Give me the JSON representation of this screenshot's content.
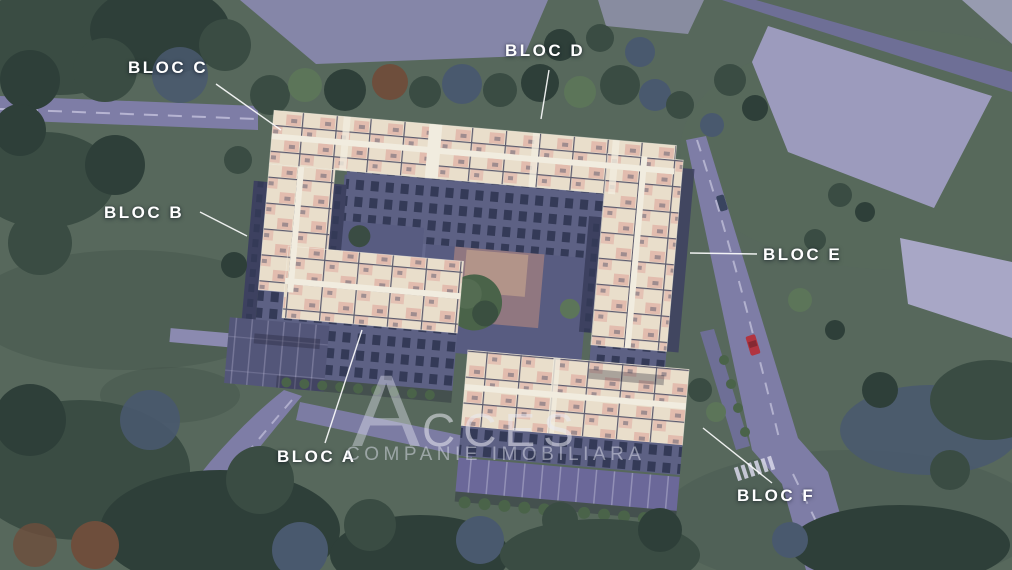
{
  "labels": [
    {
      "id": "bloc-a",
      "text": "BLOC A"
    },
    {
      "id": "bloc-b",
      "text": "BLOC B"
    },
    {
      "id": "bloc-c",
      "text": "BLOC C"
    },
    {
      "id": "bloc-d",
      "text": "BLOC D"
    },
    {
      "id": "bloc-e",
      "text": "BLOC E"
    },
    {
      "id": "bloc-f",
      "text": "BLOC F"
    }
  ],
  "watermark": {
    "brand": "ACCES",
    "tagline": "COMPANIE IMOBILIARA"
  },
  "palette": {
    "grass": "#57685c",
    "grass_dark": "#46564c",
    "forest": "#3a4c43",
    "forest_dark": "#2e3f39",
    "tree_blue": "#49596e",
    "tree_light": "#5c7559",
    "tree_autumn": "#6e4e3c",
    "road": "#7e7da6",
    "road_dark": "#6e6f96",
    "road_line": "#c9c7e0",
    "lot_lavender": "#9c9bbd",
    "lot_pale": "#a8a7c6",
    "pavement": "#8b8ab0",
    "roof_cream": "#e9decb",
    "roof_pink": "#e2bcae",
    "roof_line": "#5c5b6e",
    "walkway": "#f1ecdf",
    "facade": "#5d6184",
    "facade_dark": "#3d4160",
    "window": "#343a57",
    "courtyard": "#585c81",
    "playground": "#977a80",
    "playground_sand": "#c9a98f",
    "hedge": "#4a6349",
    "parking": "#535679",
    "parking_f": "#6b6899",
    "stall_line": "#b9b7d4",
    "shadow": "rgba(25,28,48,0.3)",
    "label": "#ffffff",
    "watermark": "rgba(233,234,243,0.55)",
    "watermark2": "rgba(224,226,238,0.5)",
    "car_red": "#b13440",
    "car_dark": "#39445f"
  }
}
